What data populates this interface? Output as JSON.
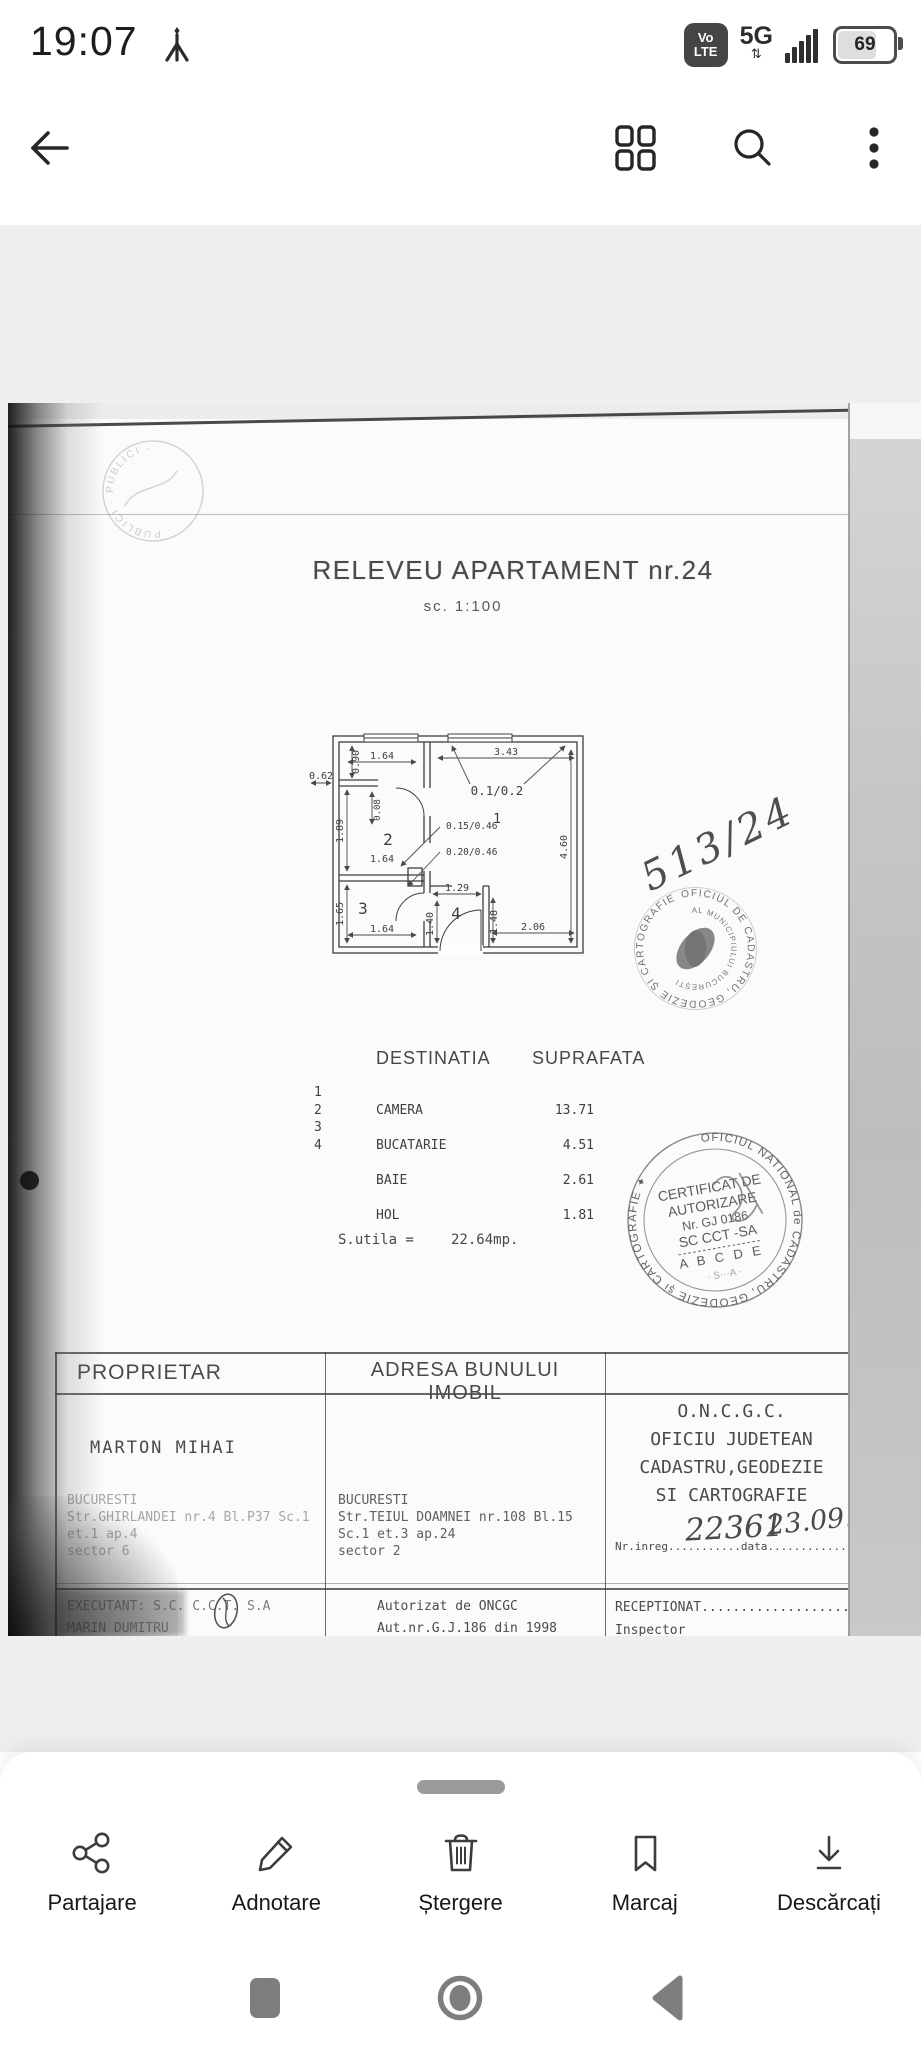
{
  "status_bar": {
    "time": "19:07",
    "volte_top": "Vo",
    "volte_bottom": "LTE",
    "network": "5G",
    "network_sub": "⇅",
    "battery_percent": "69"
  },
  "document": {
    "title": "RELEVEU APARTAMENT nr.24",
    "scale": "sc. 1:100",
    "faint_stamp_text": "· PUBLICI · PUBLICI ·",
    "plan": {
      "rooms": {
        "r1": "1",
        "r2": "2",
        "r3": "3",
        "r4": "4"
      },
      "dims": {
        "top_left": "1.64",
        "vert_090": "0.90",
        "left_062": "0.62",
        "top_right": "3.43",
        "window_note": "0.1/0.2",
        "vert_189": "1.89",
        "vert_008": "0.08",
        "door_note_1": "0.15/0.46",
        "door_note_2": "0.20/0.46",
        "mid_164": "1.64",
        "right_460": "4.60",
        "vert_165": "1.65",
        "hall_129": "1.29",
        "hall_140": "1.40",
        "hall_148": "1.48",
        "bottom_164": "1.64",
        "bottom_206": "2.06"
      }
    },
    "handwriting": {
      "plan_note": "513/24",
      "reg_number": "22361",
      "reg_date": "23.09.'99"
    },
    "stamp_municipal": {
      "ring": "OFICIUL DE CADASTRU, GEODEZIE ȘI CARTOGRAFIE ✱ 2 ✱",
      "inner": "AL MUNICIPIULUI BUCUREȘTI"
    },
    "areas": {
      "col_destination": "DESTINATIA",
      "col_area": "SUPRAFATA",
      "nums": "1\n2\n3\n4",
      "rows": [
        {
          "num": "1",
          "name": "CAMERA",
          "area": "13.71"
        },
        {
          "num": "2",
          "name": "BUCATARIE",
          "area": "4.51"
        },
        {
          "num": "3",
          "name": "BAIE",
          "area": "2.61"
        },
        {
          "num": "4",
          "name": "HOL",
          "area": "1.81"
        }
      ],
      "total_label": "S.utila =",
      "total_value": "22.64mp."
    },
    "stamp_certificate": {
      "ring": "OFICIUL NATIONAL de CADASTRU, GEODEZIE și CARTOGRAFIE ✦",
      "line1": "CERTIFICAT DE",
      "line2": "AUTORIZARE",
      "line3": "Nr. GJ 0186",
      "line4": "SC CCT -SA",
      "line5": "A B C D E",
      "line6": "· S···A ·"
    },
    "info_table": {
      "header_owner": "PROPRIETAR",
      "header_address": "ADRESA BUNULUI IMOBIL",
      "owner_name": "MARTON MIHAI",
      "owner_address": [
        "BUCURESTI",
        "Str.GHIRLANDEI nr.4 Bl.P37 Sc.1",
        "et.1 ap.4",
        "sector 6"
      ],
      "property_address": [
        "BUCURESTI",
        "Str.TEIUL DOAMNEI nr.108 Bl.15",
        "Sc.1 et.3 ap.24",
        "sector 2"
      ],
      "office_lines": [
        "O.N.C.G.C.",
        "OFICIU JUDETEAN",
        "CADASTRU,GEODEZIE",
        "SI CARTOGRAFIE"
      ],
      "reg_line": "Nr.inreg...........data...............",
      "executant_line1": "EXECUTANT: S.C. C.C.T. S.A",
      "executant_line2": "MARIN DUMITRU",
      "auth_line1": "Autorizat de ONCGC",
      "auth_line2": "Aut.nr.G.J.186 din 1998",
      "reception_line1": "RECEPTIONAT.....................",
      "reception_line2": "Inspector"
    }
  },
  "action_bar": {
    "items": [
      {
        "label": "Partajare"
      },
      {
        "label": "Adnotare"
      },
      {
        "label": "Ștergere"
      },
      {
        "label": "Marcaj"
      },
      {
        "label": "Descărcați"
      }
    ]
  },
  "colors": {
    "icon_dark": "#3c3c3c",
    "viewer_bg": "#efeff0",
    "nav_icon": "#7e7e7e",
    "paper": "#fbfbf9"
  }
}
